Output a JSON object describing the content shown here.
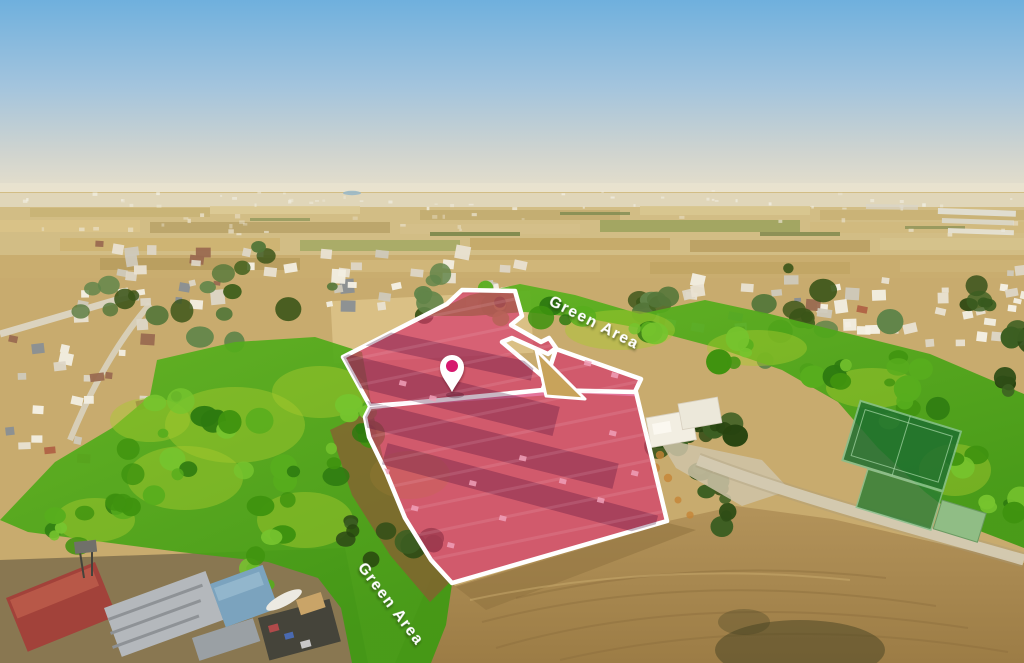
{
  "scene": {
    "colors": {
      "plot_fill": "#d6336c",
      "plot_fill_opacity": 0.68,
      "plot_stroke": "#ffffff",
      "pin_fill": "#ffffff",
      "pin_dot": "#d6186e",
      "green_overlay_light": "#a9c92f",
      "green_overlay_base": "#4e9a1c",
      "green_overlay_dark": "#2d7a10",
      "label_color": "#ffffff"
    },
    "pin": {
      "x": 452,
      "y": 367,
      "tip_y": 392,
      "outer_r": 12,
      "dot_r": 6
    },
    "plot": {
      "parcels": [
        {
          "name": "parcel-upper",
          "points": "462,290 515,291 522,316 511,325 541,342 549,338 556,348 548,354 512,338 502,342 553,385 547,393 370,406 343,357 447,304"
        },
        {
          "name": "parcel-right",
          "points": "556,349 641,379 634,394 543,389"
        },
        {
          "name": "parcel-lower",
          "points": "370,407 543,390 636,392 667,521 452,583 431,560 405,518 386,472 369,437 365,417"
        }
      ],
      "gap_wedge": {
        "points": "536,350 585,399 546,396",
        "fill": "#c8a35b"
      }
    },
    "green_areas": [
      {
        "name": "green-area-upper",
        "label": "Green Area",
        "points": "425,316 470,295 520,284 575,295 640,314 705,300 770,314 850,334 930,354 1024,394 1024,548 972,528 925,492 878,448 838,402 782,370 718,348 650,330 585,318 525,312 472,316",
        "label_x": 592,
        "label_y": 327,
        "label_rotation": 27
      },
      {
        "name": "green-area-lower",
        "label": "Green Area",
        "points": "0,520 55,462 112,428 150,396 157,360 235,342 315,337 362,352 372,408 386,472 406,518 432,558 452,584 446,625 431,663 352,663 341,608 318,578 268,562 180,552 88,540 28,532",
        "label_x": 387,
        "label_y": 607,
        "label_rotation": 53
      }
    ]
  }
}
